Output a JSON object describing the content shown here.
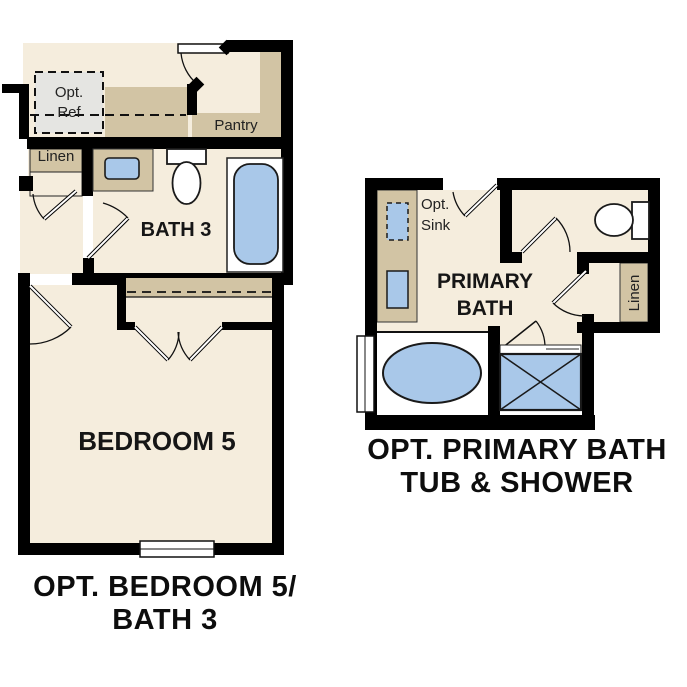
{
  "left_plan": {
    "caption": [
      "OPT. BEDROOM 5/",
      "BATH 3"
    ],
    "labels": {
      "opt_ref": [
        "Opt.",
        "Ref"
      ],
      "linen": "Linen",
      "pantry": "Pantry",
      "bath": "BATH 3",
      "bedroom": "BEDROOM 5"
    },
    "fixtures": [
      "optional-refrigerator",
      "kitchen-counter",
      "pantry-shelves",
      "linen-closet",
      "vanity-sink",
      "toilet",
      "bathtub",
      "bedroom-closet",
      "window"
    ]
  },
  "right_plan": {
    "caption": [
      "OPT. PRIMARY BATH",
      "TUB & SHOWER"
    ],
    "labels": {
      "opt_sink": [
        "Opt.",
        "Sink"
      ],
      "primary_bath": [
        "PRIMARY",
        "BATH"
      ],
      "linen": "Linen"
    },
    "fixtures": [
      "vanity",
      "optional-sink",
      "sink",
      "toilet",
      "linen-closet",
      "oval-bathtub",
      "shower",
      "window"
    ]
  },
  "colors": {
    "wall": "#000000",
    "floor": "#f5eddd",
    "cabinetry_tan": "#d2c4a4",
    "fixture_blue": "#a9c8e9",
    "opt_ref_gray": "#e5e5e2",
    "outline": "#1a1a1a",
    "background": "#ffffff"
  }
}
